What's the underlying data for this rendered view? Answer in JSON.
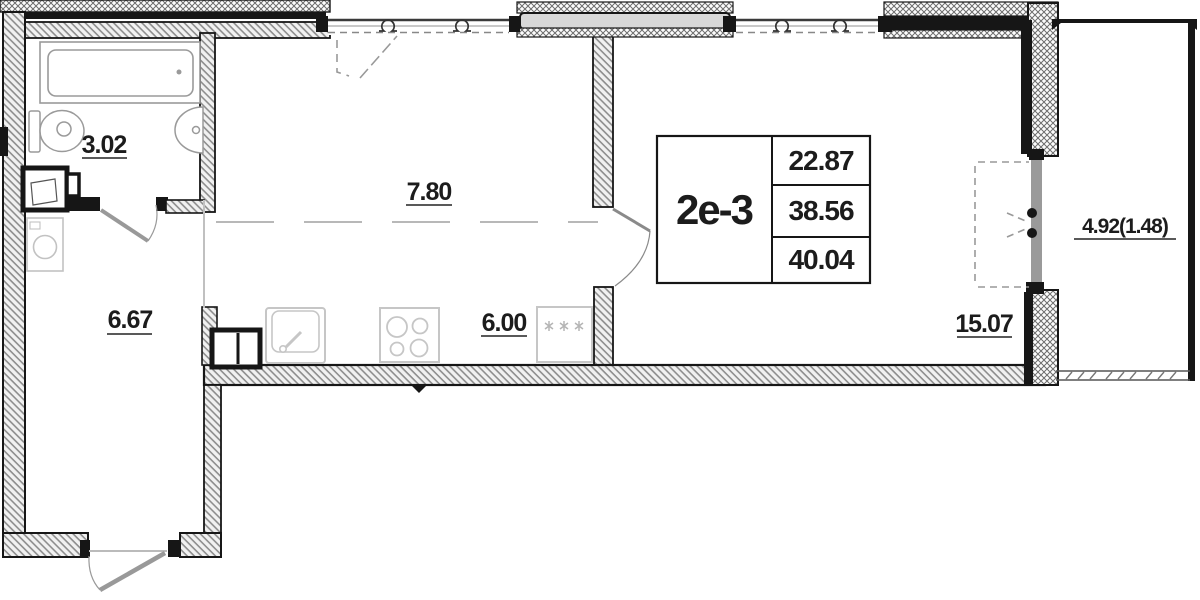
{
  "stamp": {
    "unit": "2e-3",
    "values": [
      "22.87",
      "38.56",
      "40.04"
    ]
  },
  "labels": {
    "bathroom": "3.02",
    "corridor": "7.80",
    "hallway": "6.67",
    "kitchen": "6.00",
    "living": "15.07",
    "balcony": "4.92(1.48)"
  },
  "colors": {
    "wall_line": "#161616",
    "fixture_gray": "#c6c6c6",
    "bath_gray": "#9a9a9a",
    "door_gray": "#999999",
    "dash_gray": "#b8b8b8"
  }
}
